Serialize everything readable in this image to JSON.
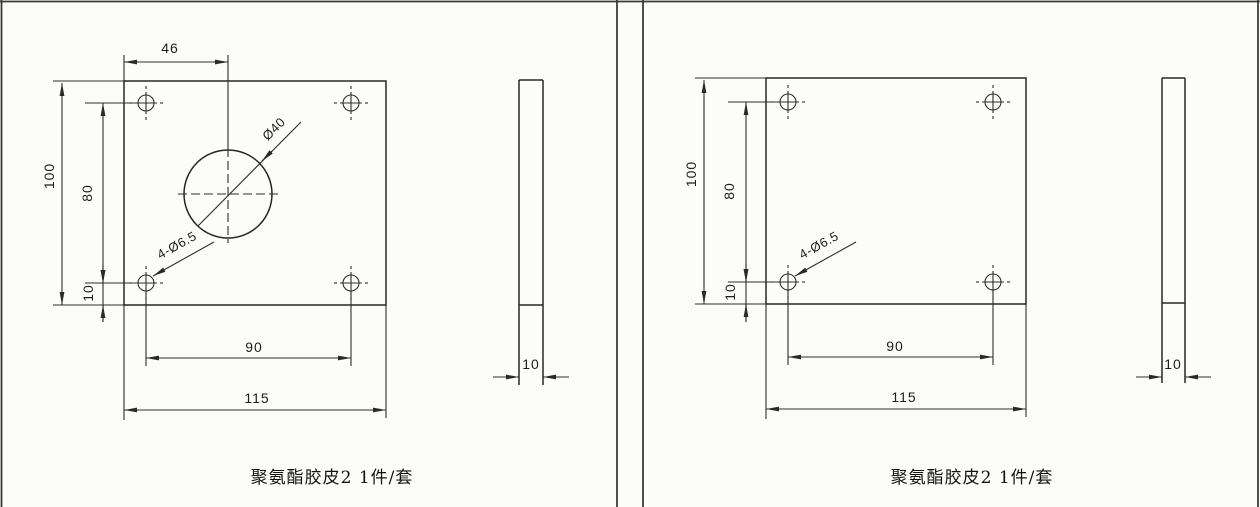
{
  "left_drawing": {
    "caption": "聚氨酯胶皮2 1件/套",
    "dimensions": {
      "center_hole_offset_x": "46",
      "plate_height": "100",
      "hole_spacing_vertical": "80",
      "hole_edge_offset": "10",
      "hole_spacing_horizontal": "90",
      "plate_width": "115",
      "thickness": "10",
      "corner_holes_label": "4-Ø6.5",
      "center_hole_diameter": "Ø40"
    }
  },
  "right_drawing": {
    "caption": "聚氨酯胶皮2 1件/套",
    "dimensions": {
      "plate_height": "100",
      "hole_spacing_vertical": "80",
      "hole_edge_offset": "10",
      "hole_spacing_horizontal": "90",
      "plate_width": "115",
      "thickness": "10",
      "corner_holes_label": "4-Ø6.5"
    }
  },
  "colors": {
    "background": "#fcfcfb",
    "line": "#2e2e2e"
  }
}
